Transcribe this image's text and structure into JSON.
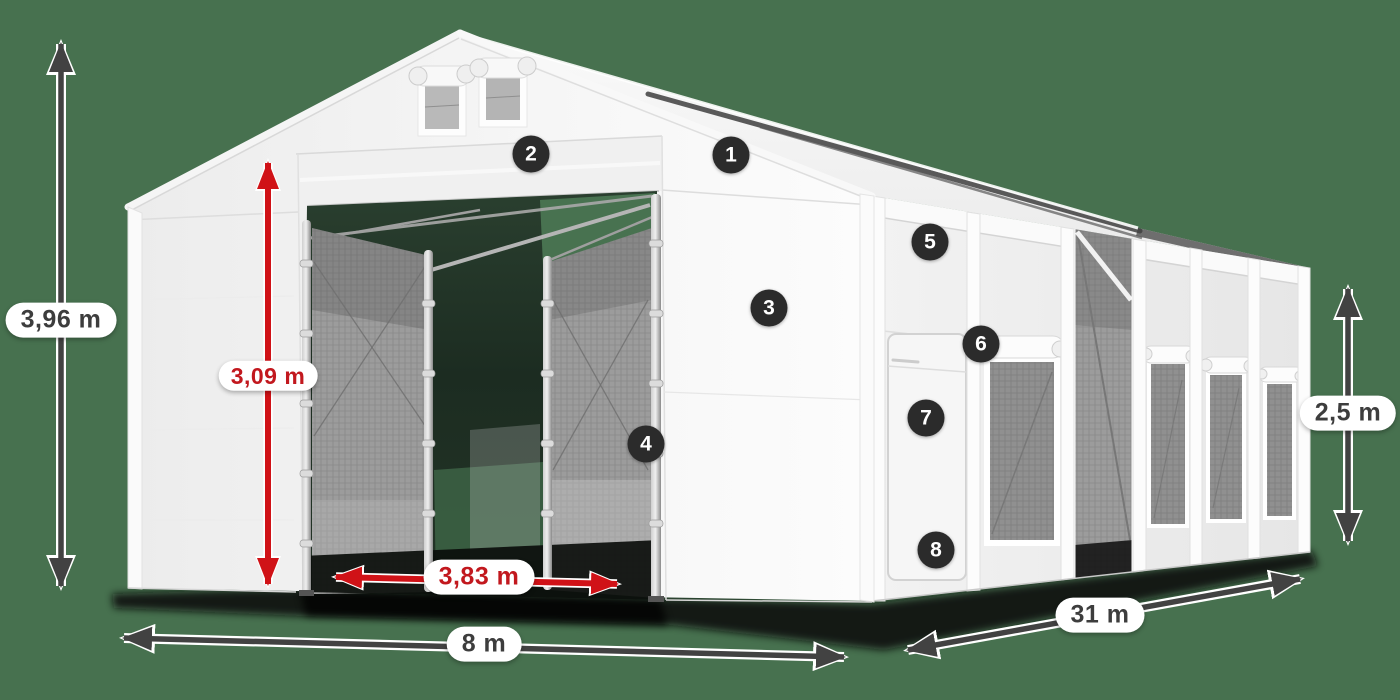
{
  "scene": {
    "description": "White storage marquee tent shown in perspective with numbered feature callouts and dimension arrows",
    "background_color": "#47714f"
  },
  "colors": {
    "dimension_dark": "#424242",
    "dimension_red": "#d01217",
    "pill_background": "#ffffff",
    "pill_text_dark": "#3d3d3d",
    "pill_text_red": "#c2181e",
    "badge_background": "#2b2b2b",
    "badge_text": "#ffffff"
  },
  "dimensions": {
    "total_height": {
      "label": "3,96 m",
      "color": "dark"
    },
    "door_height": {
      "label": "3,09 m",
      "color": "red"
    },
    "door_width": {
      "label": "3,83 m",
      "color": "red"
    },
    "width": {
      "label": "8 m",
      "color": "dark"
    },
    "length": {
      "label": "31 m",
      "color": "dark"
    },
    "side_height": {
      "label": "2,5 m",
      "color": "dark"
    }
  },
  "badges": [
    {
      "number": "1"
    },
    {
      "number": "2"
    },
    {
      "number": "3"
    },
    {
      "number": "4"
    },
    {
      "number": "5"
    },
    {
      "number": "6"
    },
    {
      "number": "7"
    },
    {
      "number": "8"
    }
  ]
}
